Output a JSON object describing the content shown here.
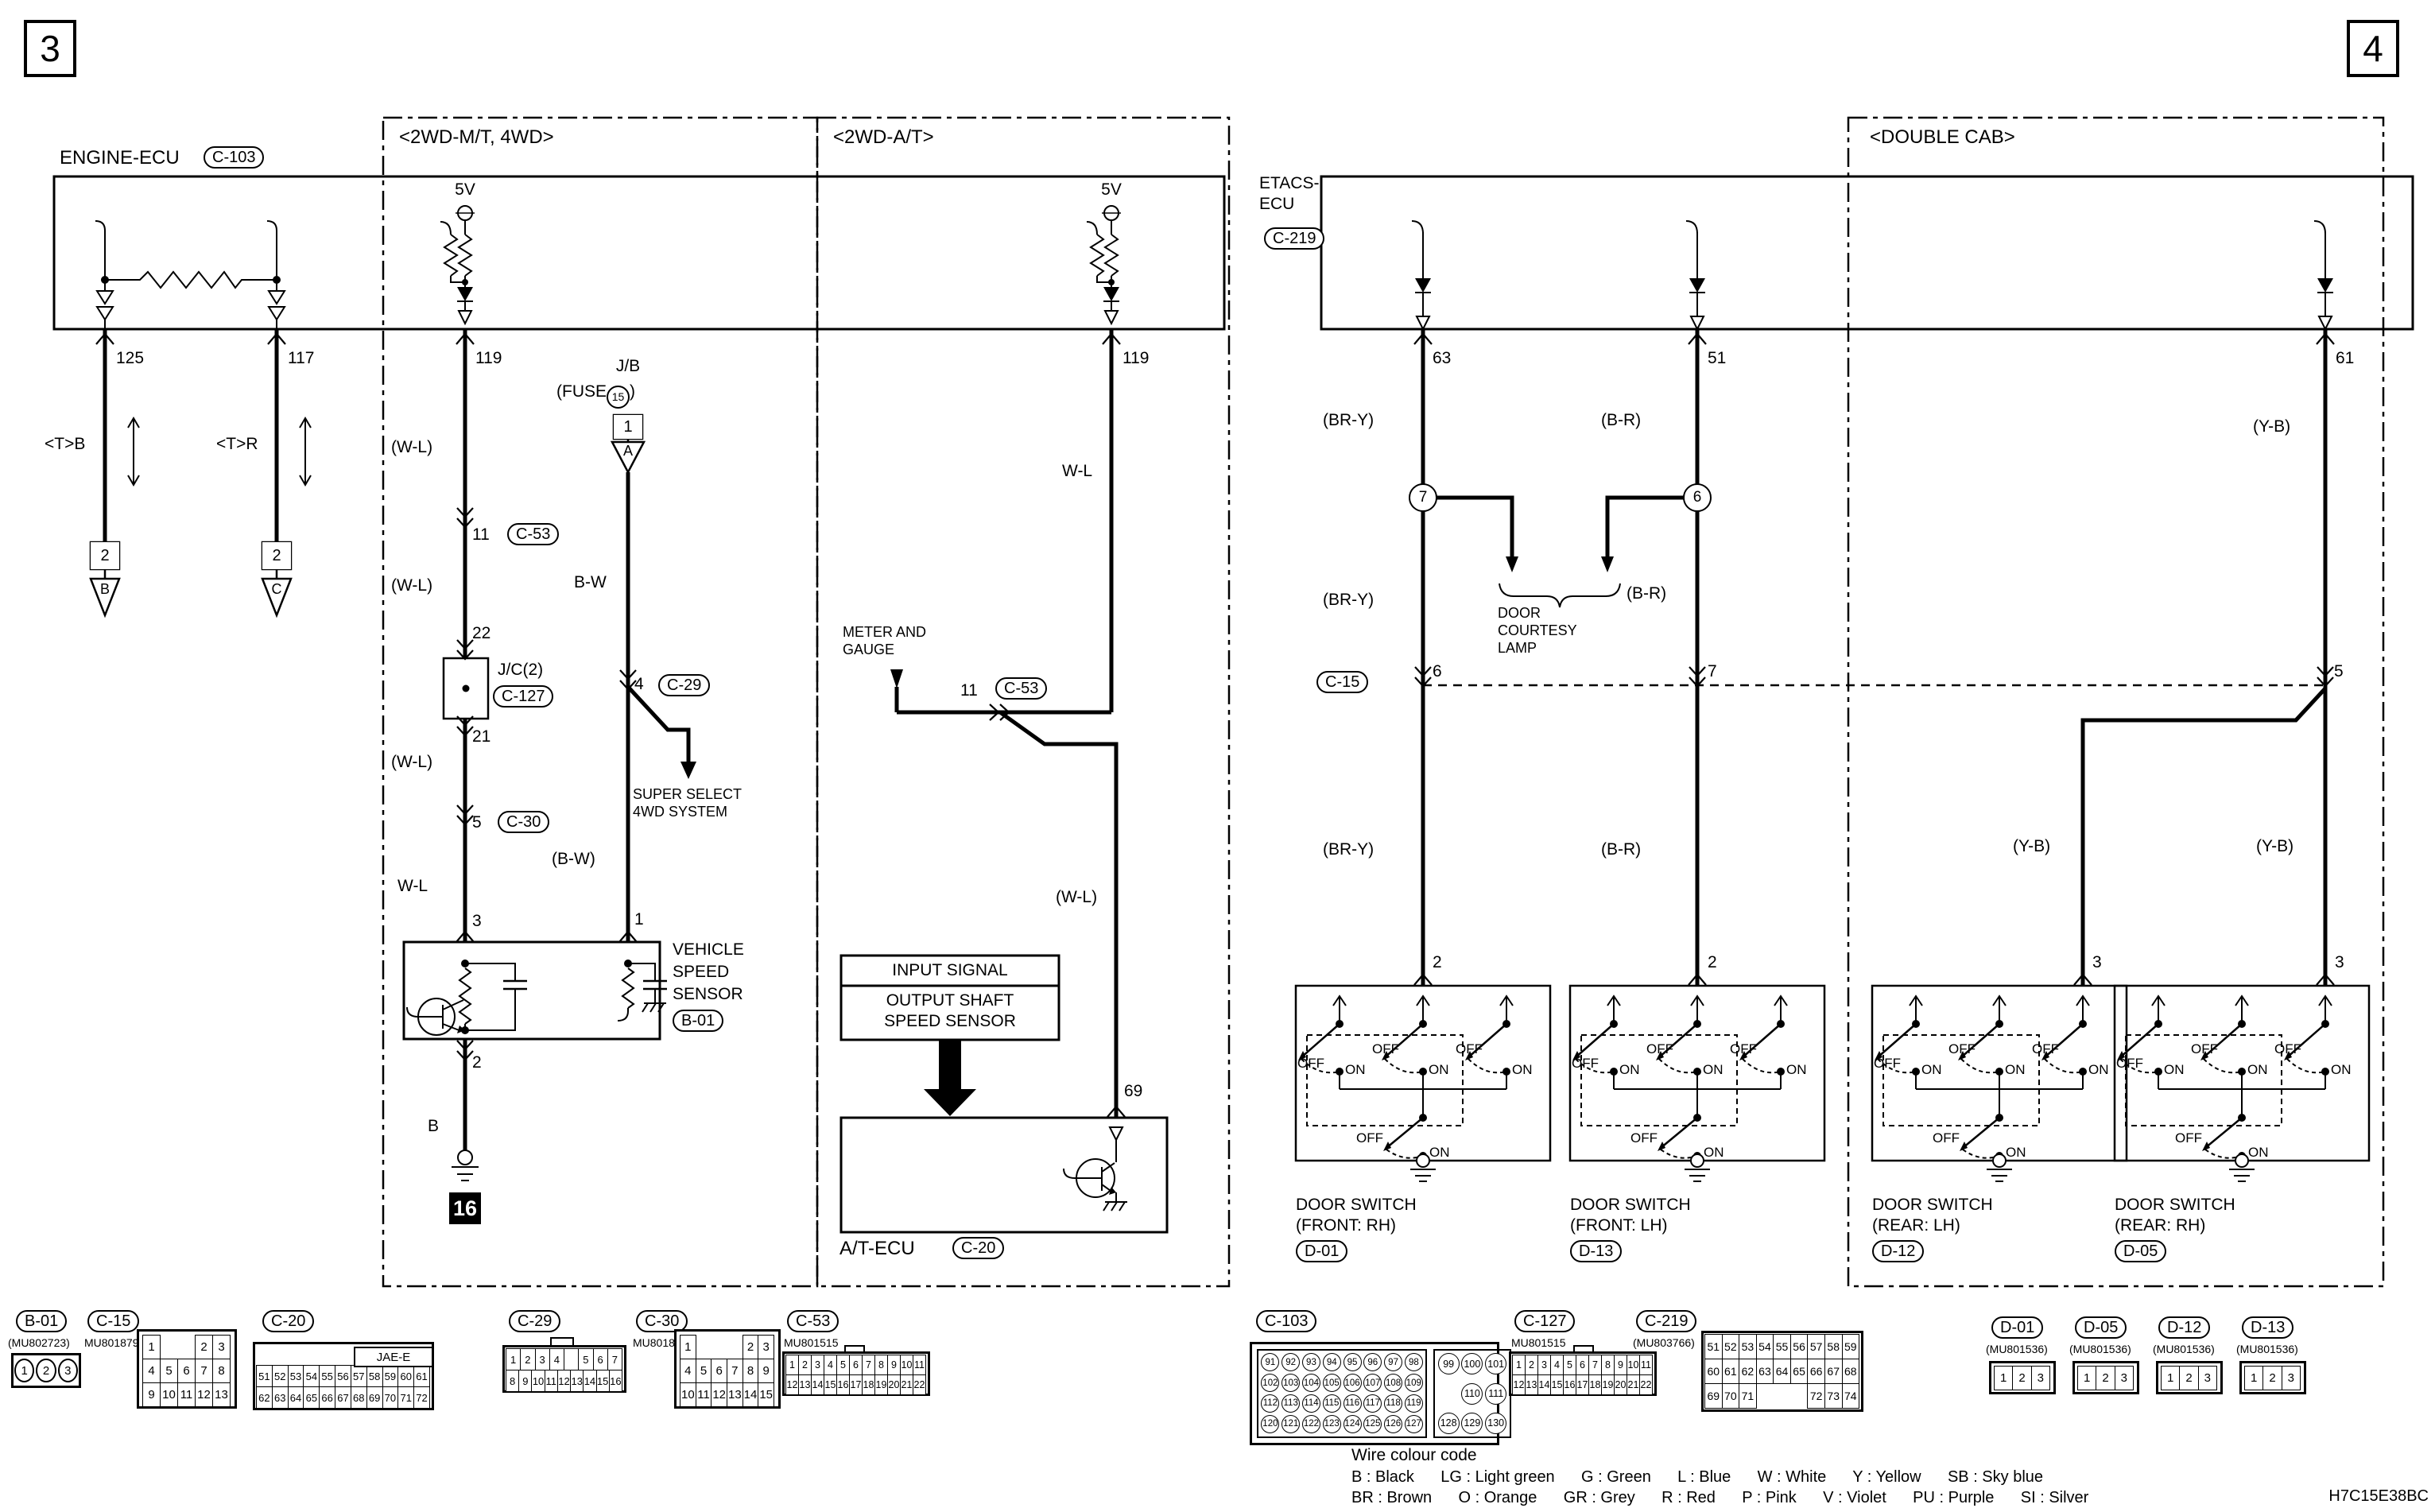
{
  "page": {
    "left_num": "3",
    "right_num": "4",
    "code": "H7C15E38BC"
  },
  "engine_ecu": {
    "title": "ENGINE-ECU",
    "connector": "C-103"
  },
  "sections": {
    "mt": "<2WD-M/T, 4WD>",
    "at": "<2WD-A/T>",
    "cab": "<DOUBLE CAB>"
  },
  "etacs": {
    "title1": "ETACS-",
    "title2": "ECU",
    "connector": "C-219"
  },
  "left": {
    "pin125": "125",
    "pin117": "117",
    "tb": "<T>B",
    "tr": "<T>R",
    "sq2": "2",
    "triB": "B",
    "triC": "C",
    "v5": "5V",
    "pin119": "119",
    "wl_paren": "(W-L)",
    "wl": "W-L",
    "n11": "11",
    "c53": "C-53",
    "n22": "22",
    "jc": "J/C(2)",
    "c127": "C-127",
    "n21": "21",
    "n5": "5",
    "c30": "C-30",
    "n3": "3",
    "n2": "2",
    "b": "B",
    "gnd16": "16",
    "jb": "J/B",
    "fuse_pre": "(FUSE",
    "fuse_num": "15",
    "fuse_post": ")",
    "sq1": "1",
    "triA": "A",
    "bw": "B-W",
    "n4": "4",
    "c29": "C-29",
    "bw_paren": "(B-W)",
    "n1": "1",
    "super1": "SUPER SELECT",
    "super2": "4WD SYSTEM",
    "vss1": "VEHICLE",
    "vss2": "SPEED",
    "vss3": "SENSOR",
    "b01": "B-01"
  },
  "at": {
    "v5": "5V",
    "pin119": "119",
    "wl": "W-L",
    "wl_paren": "(W-L)",
    "meter1": "METER AND",
    "meter2": "GAUGE",
    "n11": "11",
    "c53": "C-53",
    "input": "INPUT SIGNAL",
    "output1": "OUTPUT SHAFT",
    "output2": "SPEED SENSOR",
    "atecu": "A/T-ECU",
    "c20": "C-20",
    "n69": "69"
  },
  "right": {
    "n63": "63",
    "n51": "51",
    "n61": "61",
    "bry": "(BR-Y)",
    "br": "(B-R)",
    "yb": "(Y-B)",
    "c7": "7",
    "c6": "6",
    "lamp1": "DOOR",
    "lamp2": "COURTESY",
    "lamp3": "LAMP",
    "c15": "C-15",
    "n6": "6",
    "n7": "7",
    "n5": "5",
    "n2": "2",
    "n3": "3"
  },
  "switch": {
    "off": "OFF",
    "on": "ON"
  },
  "door_switches": [
    {
      "line1": "DOOR SWITCH",
      "line2": "(FRONT: RH)",
      "badge": "D-01"
    },
    {
      "line1": "DOOR SWITCH",
      "line2": "(FRONT: LH)",
      "badge": "D-13"
    },
    {
      "line1": "DOOR SWITCH",
      "line2": "(REAR: LH)",
      "badge": "D-12"
    },
    {
      "line1": "DOOR SWITCH",
      "line2": "(REAR: RH)",
      "badge": "D-05"
    }
  ],
  "connectors": {
    "b01": {
      "badge": "B-01",
      "part": "(MU802723)",
      "pins": [
        "1",
        "2",
        "3"
      ]
    },
    "c15": {
      "badge": "C-15",
      "part": "MU801879",
      "rows": [
        [
          "1",
          "",
          "",
          "2",
          "3"
        ],
        [
          "4",
          "5",
          "6",
          "7",
          "8"
        ],
        [
          "9",
          "10",
          "11",
          "12",
          "13"
        ]
      ]
    },
    "c20": {
      "badge": "C-20",
      "label": "JAE-E",
      "rows": [
        [
          "51",
          "52",
          "53",
          "54",
          "55",
          "56",
          "57",
          "58",
          "59",
          "60",
          "61"
        ],
        [
          "62",
          "63",
          "64",
          "65",
          "66",
          "67",
          "68",
          "69",
          "70",
          "71",
          "72"
        ]
      ]
    },
    "c29": {
      "badge": "C-29",
      "rows": [
        [
          "1",
          "2",
          "3",
          "4",
          " ",
          "5",
          "6",
          "7"
        ],
        [
          "8",
          "9",
          "10",
          "11",
          "12",
          "13",
          "14",
          "15",
          "16"
        ]
      ]
    },
    "c30": {
      "badge": "C-30",
      "part": "MU801882",
      "rows": [
        [
          "1",
          "",
          "",
          "",
          "2",
          "3"
        ],
        [
          "4",
          "5",
          "6",
          "7",
          "8",
          "9"
        ],
        [
          "10",
          "11",
          "12",
          "13",
          "14",
          "15"
        ]
      ]
    },
    "c53": {
      "badge": "C-53",
      "part": "MU801515",
      "rows": [
        [
          "1",
          "2",
          "3",
          "4",
          "5",
          "6",
          "7",
          "8",
          "9",
          "10",
          "11"
        ],
        [
          "12",
          "13",
          "14",
          "15",
          "16",
          "17",
          "18",
          "19",
          "20",
          "21",
          "22"
        ]
      ]
    },
    "c103": {
      "badge": "C-103",
      "left_rows": [
        [
          "91",
          "92",
          "93",
          "94",
          "95",
          "96",
          "97",
          "98"
        ],
        [
          "102",
          "103",
          "104",
          "105",
          "106",
          "107",
          "108",
          "109"
        ],
        [
          "112",
          "113",
          "114",
          "115",
          "116",
          "117",
          "118",
          "119"
        ],
        [
          "120",
          "121",
          "122",
          "123",
          "124",
          "125",
          "126",
          "127"
        ]
      ],
      "right_rows": [
        [
          "99",
          "100",
          "101"
        ],
        [
          "",
          "110",
          "111"
        ],
        [
          "128",
          "129",
          "130"
        ]
      ]
    },
    "c127": {
      "badge": "C-127",
      "part": "MU801515",
      "rows": [
        [
          "1",
          "2",
          "3",
          "4",
          "5",
          "6",
          "7",
          "8",
          "9",
          "10",
          "11"
        ],
        [
          "12",
          "13",
          "14",
          "15",
          "16",
          "17",
          "18",
          "19",
          "20",
          "21",
          "22"
        ]
      ]
    },
    "c219": {
      "badge": "C-219",
      "part": "(MU803766)",
      "rows": [
        [
          "51",
          "52",
          "53",
          "54",
          "55",
          "56",
          "57",
          "58",
          "59"
        ],
        [
          "60",
          "61",
          "62",
          "63",
          "64",
          "65",
          "66",
          "67",
          "68"
        ],
        [
          "69",
          "70",
          "71",
          "",
          "",
          "",
          "72",
          "73",
          "74"
        ]
      ]
    },
    "d01": {
      "badge": "D-01",
      "part": "(MU801536)",
      "pins": [
        "1",
        "2",
        "3"
      ]
    },
    "d05": {
      "badge": "D-05",
      "part": "(MU801536)",
      "pins": [
        "1",
        "2",
        "3"
      ]
    },
    "d12": {
      "badge": "D-12",
      "part": "(MU801536)",
      "pins": [
        "1",
        "2",
        "3"
      ]
    },
    "d13": {
      "badge": "D-13",
      "part": "(MU801536)",
      "pins": [
        "1",
        "2",
        "3"
      ]
    }
  },
  "legend": {
    "title": "Wire colour code",
    "line1": "B : Black      LG : Light green      G : Green      L : Blue      W : White      Y : Yellow      SB : Sky blue",
    "line2": "BR : Brown      O : Orange      GR : Grey      R : Red      P : Pink      V : Violet      PU : Purple      SI : Silver"
  }
}
